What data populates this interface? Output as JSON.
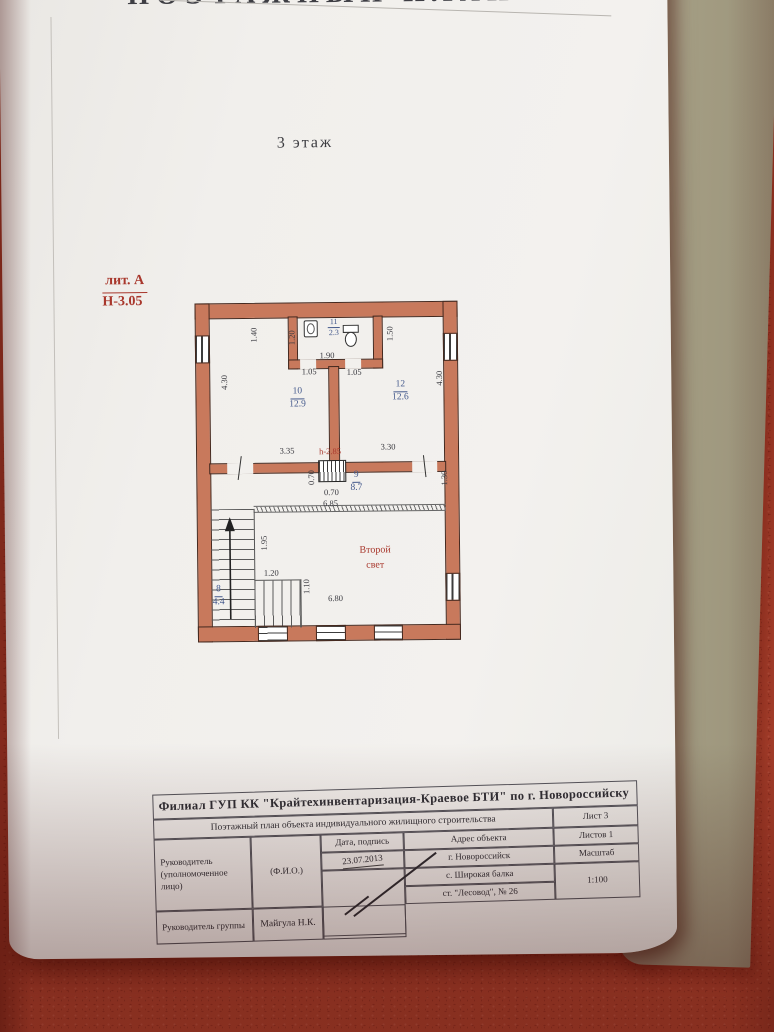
{
  "photo": {
    "fabric_color": "#bd4a34",
    "cardboard_color": "#a39c82",
    "paper_color": "#f1efec",
    "wall_color": "#c8795c",
    "room_number_color": "#44598c",
    "red_annotation_color": "#a8372c"
  },
  "page": {
    "top_title": "ПОЭТАЖНЫЙ ПЛАН",
    "floor_label": "3 этаж",
    "liter_label": "лит. А",
    "height_label": "Н-3.05"
  },
  "plan": {
    "ceiling_height": "h-2.85",
    "second_light_line1": "Второй",
    "second_light_line2": "свет",
    "rooms": [
      {
        "number": "10",
        "area": "12.9"
      },
      {
        "number": "12",
        "area": "12.6"
      },
      {
        "number": "11",
        "area": "2.3"
      },
      {
        "number": "9",
        "area": "8.7"
      },
      {
        "number": "8",
        "area": "4.4"
      }
    ],
    "dims": [
      {
        "t": "1.40"
      },
      {
        "t": "1.20"
      },
      {
        "t": "1.90"
      },
      {
        "t": "1.50"
      },
      {
        "t": "1.05"
      },
      {
        "t": "1.05"
      },
      {
        "t": "4.30"
      },
      {
        "t": "4.30"
      },
      {
        "t": "3.35"
      },
      {
        "t": "3.30"
      },
      {
        "t": "0.70"
      },
      {
        "t": "0.70"
      },
      {
        "t": "1.30"
      },
      {
        "t": "6.85"
      },
      {
        "t": "1.95"
      },
      {
        "t": "1.20"
      },
      {
        "t": "1.10"
      },
      {
        "t": "6.80"
      }
    ]
  },
  "title_block": {
    "org": "Филиал ГУП КК \"Крайтехинвентаризация-Краевое БТИ\" по г. Новороссийску",
    "doc_type": "Поэтажный план объекта индивидуального жилищного строительства",
    "sheet": "Лист 3",
    "sheets": "Листов 1",
    "scale_label": "Масштаб",
    "scale_value": "1:100",
    "date_sign_label": "Дата, подпись",
    "date_value": "23.07.2013",
    "address_label": "Адрес объекта",
    "address_lines": [
      "г. Новороссийск",
      "с. Широкая балка",
      "ст. \"Лесовод\", № 26"
    ],
    "role1": "Руководитель (уполномоченное лицо)",
    "fio_label": "(Ф.И.О.)",
    "role2": "Руководитель группы",
    "fio2_value": "Майгула Н.К."
  }
}
